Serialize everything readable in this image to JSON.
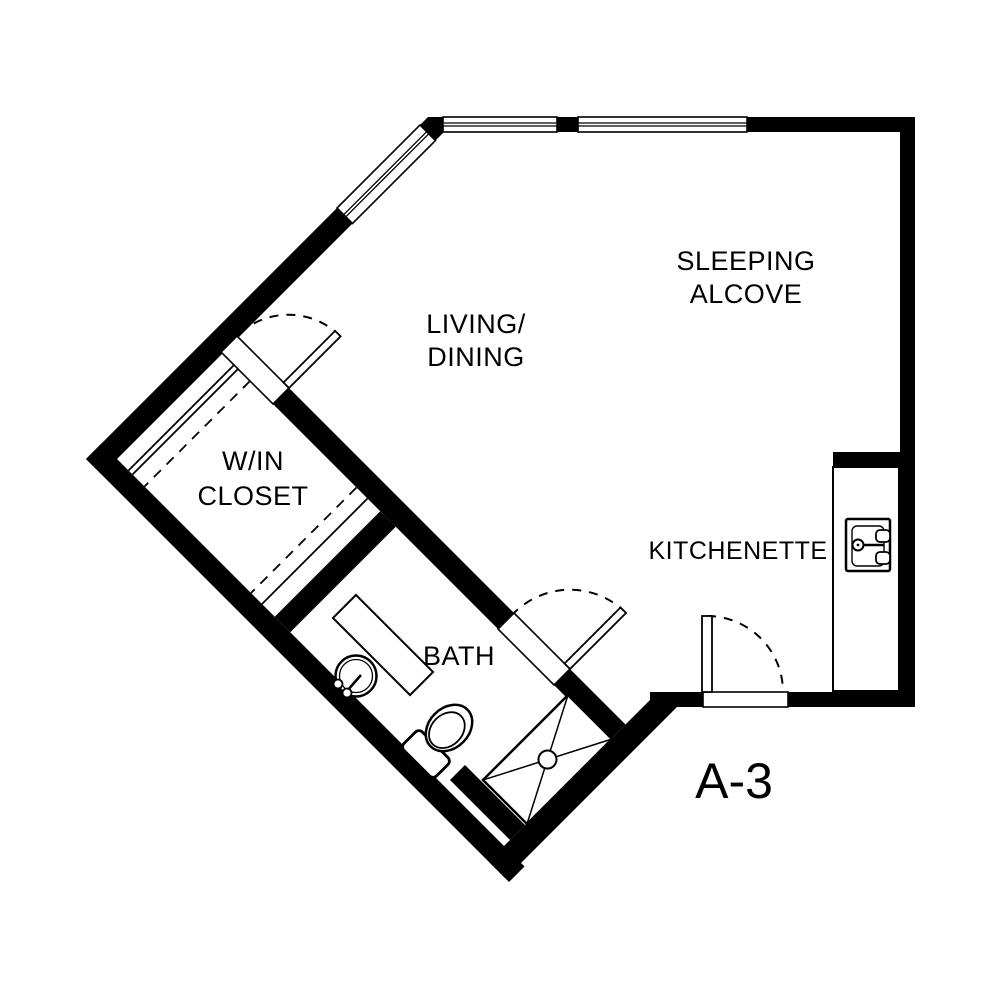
{
  "document": {
    "type": "architectural floor plan",
    "unit": "A-3",
    "background_color": "#ffffff",
    "wall_color": "#000000"
  },
  "labels": {
    "sleeping_line1": "SLEEPING",
    "sleeping_line2": "ALCOVE",
    "living_line1": "LIVING/",
    "living_line2": "DINING",
    "closet_line1": "W/IN",
    "closet_line2": "CLOSET",
    "kitchenette": "KITCHENETTE",
    "bath": "BATH",
    "unit_label": "A-3"
  },
  "fixtures": [
    "kitchen-sink",
    "kitchen-counter",
    "bath-pedestal-sink",
    "bath-vanity-stub",
    "toilet",
    "shower-pan"
  ],
  "openings": {
    "windows": 3,
    "doors": 3
  }
}
